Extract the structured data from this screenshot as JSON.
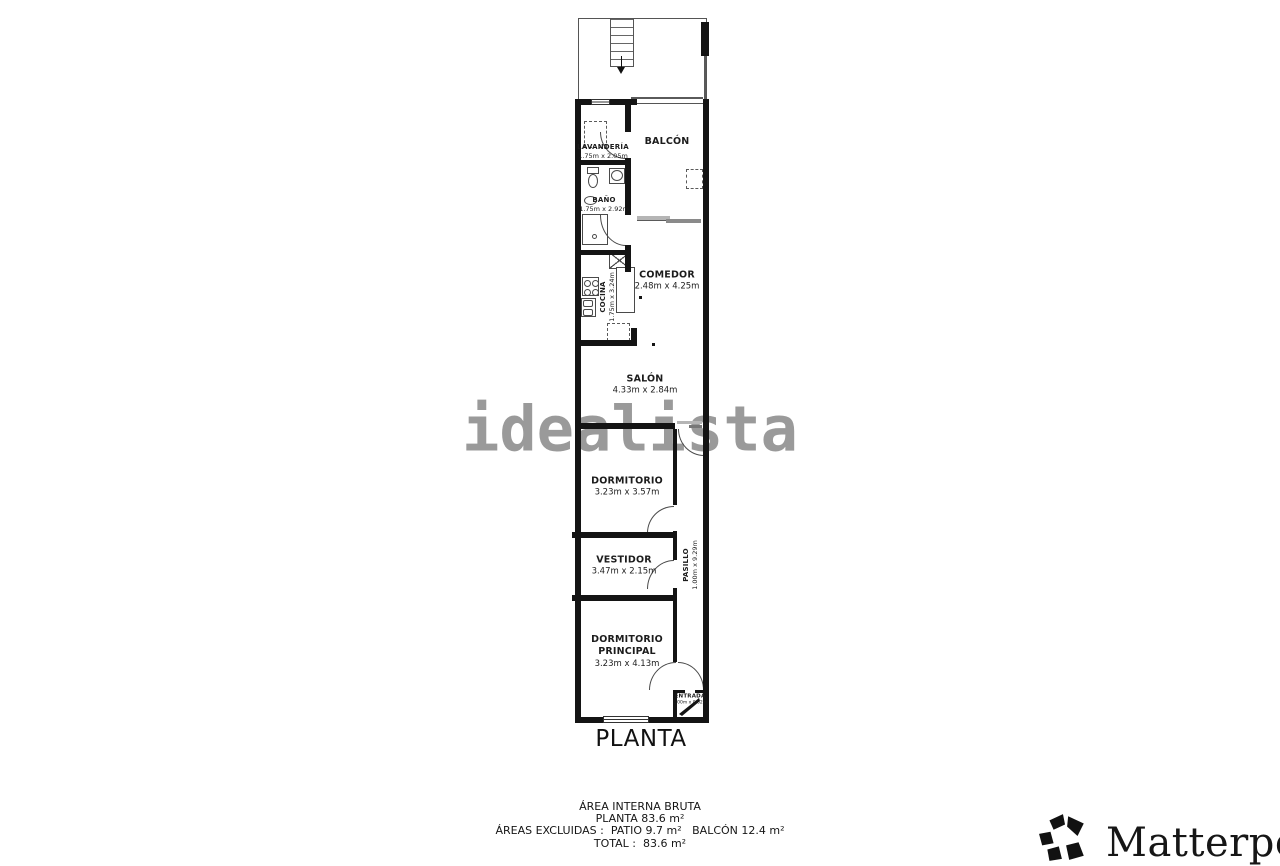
{
  "plan": {
    "title": "PLANTA",
    "watermark": "idealista",
    "rooms": {
      "lavanderia": {
        "name": "LAVANDERÍA",
        "dims": "1.75m x 2.05m"
      },
      "bano": {
        "name": "BAÑO",
        "dims": "1.75m x 2.92m"
      },
      "cocina": {
        "name": "COCINA",
        "dims": "1.75m x 3.24m"
      },
      "balcon": {
        "name": "BALCÓN"
      },
      "comedor": {
        "name": "COMEDOR",
        "dims": "2.48m x 4.25m"
      },
      "salon": {
        "name": "SALÓN",
        "dims": "4.33m x 2.84m"
      },
      "dormitorio": {
        "name": "DORMITORIO",
        "dims": "3.23m x 3.57m"
      },
      "pasillo": {
        "name": "PASILLO",
        "dims": "1.00m x 9.29m"
      },
      "vestidor": {
        "name": "VESTIDOR",
        "dims": "3.47m x 2.15m"
      },
      "dormitorio_principal": {
        "name": "DORMITORIO PRINCIPAL",
        "dims": "3.23m x 4.13m"
      },
      "entrada": {
        "name": "ENTRADA",
        "dims": "1.00m x 0.62m"
      }
    }
  },
  "summary": {
    "line1": "ÁREA INTERNA BRUTA",
    "line2": "PLANTA 83.6 m²",
    "line3": "ÁREAS EXCLUIDAS :  PATIO 9.7 m²   BALCÓN 12.4 m²",
    "line4": "TOTAL :  83.6 m²"
  },
  "branding": {
    "name": "Matterport",
    "registered": "®"
  },
  "colors": {
    "wall": "#141414",
    "watermark": "#9a9a9a",
    "background": "#ffffff"
  }
}
